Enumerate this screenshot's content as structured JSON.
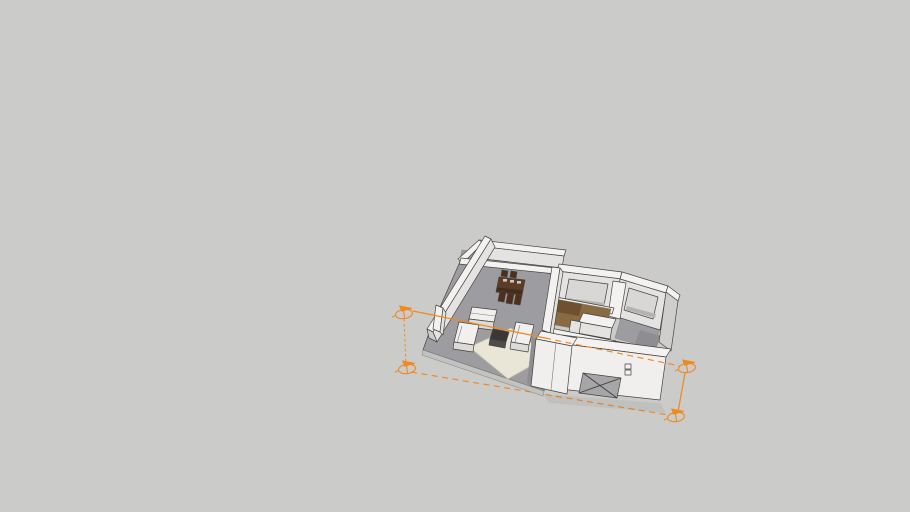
{
  "viewport": {
    "kind": "3d-model-viewport",
    "width": 910,
    "height": 512
  },
  "colors": {
    "background": "#cbcbca",
    "floor": "#9d9da1",
    "floor_dark": "#8e8e92",
    "floor_edge": "#c2c2c0",
    "wall_top": "#f3f2f0",
    "wall_face": "#e4e3e1",
    "wall_shade": "#cfcecc",
    "window_recess": "#d8d7d5",
    "window_sill": "#b3b3b1",
    "lattice_dark": "#3a362f",
    "lattice_cell": "#efeeea",
    "wood": "#8a6a42",
    "wood_dark": "#6f5130",
    "rug": "#e9e6d8",
    "rug_edge": "#b9b5a3",
    "coffee_table_top": "#3a3836",
    "coffee_table_front": "#4e4b48",
    "dining_table_top": "#5d3b24",
    "dining_table_front": "#482c18",
    "dining_chair": "#4f2f1b",
    "tableware": "#c9c7c3",
    "sofa_top": "#f1f0ee",
    "sofa_front": "#dcdbd9",
    "x_panel": "#a6a6a9",
    "volume_white": "#f0efed",
    "shadow": "rgba(0,0,0,0.05)",
    "edge": "#45433f",
    "guide_orange": "#ee8a1f"
  },
  "scene": {
    "objects": [
      "balcony-terrace",
      "lattice-screen-wall",
      "dining-set",
      "left-exterior-wall",
      "living-room-floor",
      "area-rug",
      "coffee-table",
      "sofa-sectional",
      "bedroom-1-window-wall",
      "bedroom-2-window-wall",
      "wood-floor-hallway",
      "kitchen-island",
      "utility-block-with-x-panel",
      "orange-guide-box",
      "guide-corner-markers"
    ]
  }
}
